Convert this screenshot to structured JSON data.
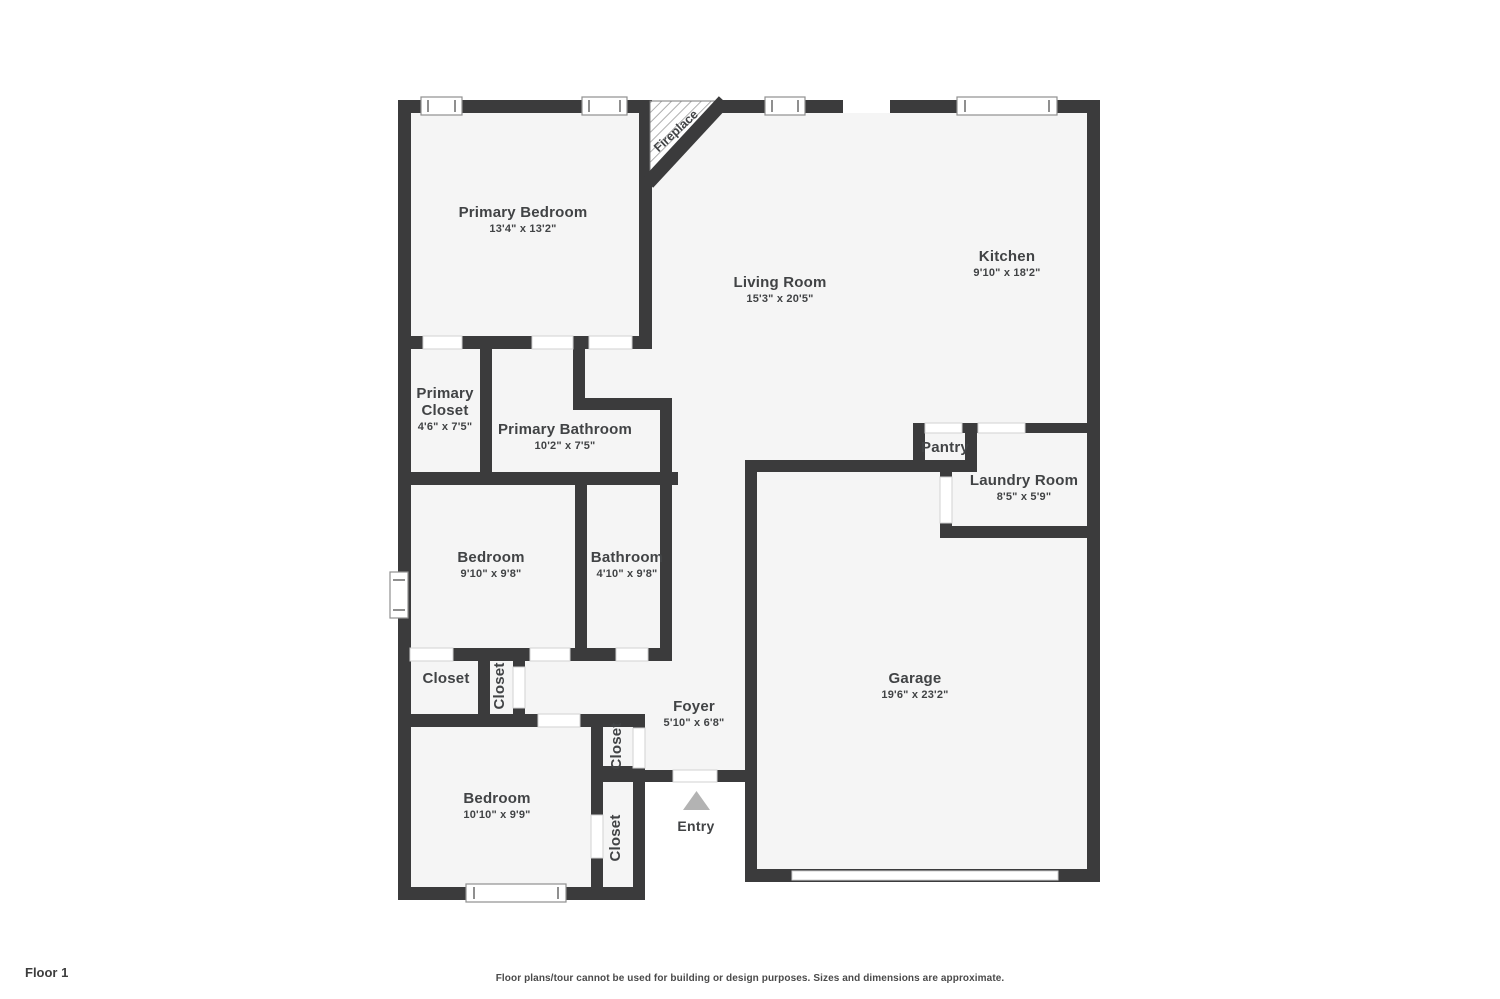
{
  "plan": {
    "floor_label": "Floor 1",
    "disclaimer": "Floor plans/tour cannot be used for building or design purposes. Sizes and dimensions are approximate.",
    "colors": {
      "wall": "#3b3b3c",
      "room_fill": "#f5f5f5",
      "text": "#414345",
      "entry_arrow": "#b3b3b3",
      "window_stroke": "#8f8f8f"
    }
  },
  "rooms": [
    {
      "name": "Primary Bedroom",
      "dims": "13'4\" x 13'2\"",
      "x": 523,
      "y": 220
    },
    {
      "name": "Living Room",
      "dims": "15'3\" x 20'5\"",
      "x": 780,
      "y": 290
    },
    {
      "name": "Kitchen",
      "dims": "9'10\" x 18'2\"",
      "x": 1007,
      "y": 264
    },
    {
      "name": "Primary Closet",
      "dims": "4'6\" x 7'5\"",
      "x": 445,
      "y": 409,
      "wrap": true
    },
    {
      "name": "Primary Bathroom",
      "dims": "10'2\" x 7'5\"",
      "x": 565,
      "y": 437
    },
    {
      "name": "Pantry",
      "dims": null,
      "x": 945,
      "y": 448
    },
    {
      "name": "Laundry Room",
      "dims": "8'5\" x 5'9\"",
      "x": 1024,
      "y": 488
    },
    {
      "name": "Bedroom",
      "dims": "9'10\" x 9'8\"",
      "x": 491,
      "y": 565
    },
    {
      "name": "Bathroom",
      "dims": "4'10\" x 9'8\"",
      "x": 627,
      "y": 565
    },
    {
      "name": "Closet",
      "dims": null,
      "x": 446,
      "y": 679
    },
    {
      "name": "Closet",
      "dims": null,
      "x": 500,
      "y": 686,
      "rotate": true
    },
    {
      "name": "Foyer",
      "dims": "5'10\" x 6'8\"",
      "x": 694,
      "y": 714
    },
    {
      "name": "Garage",
      "dims": "19'6\" x 23'2\"",
      "x": 915,
      "y": 686
    },
    {
      "name": "Closet",
      "dims": null,
      "x": 617,
      "y": 746,
      "rotate": true
    },
    {
      "name": "Closet",
      "dims": null,
      "x": 616,
      "y": 838,
      "rotate": true
    },
    {
      "name": "Bedroom",
      "dims": "10'10\" x 9'9\"",
      "x": 497,
      "y": 806
    }
  ],
  "annotations": {
    "fireplace": {
      "label": "Fireplace",
      "x": 676,
      "y": 131
    },
    "entry": {
      "label": "Entry",
      "x": 696,
      "y": 826
    }
  }
}
